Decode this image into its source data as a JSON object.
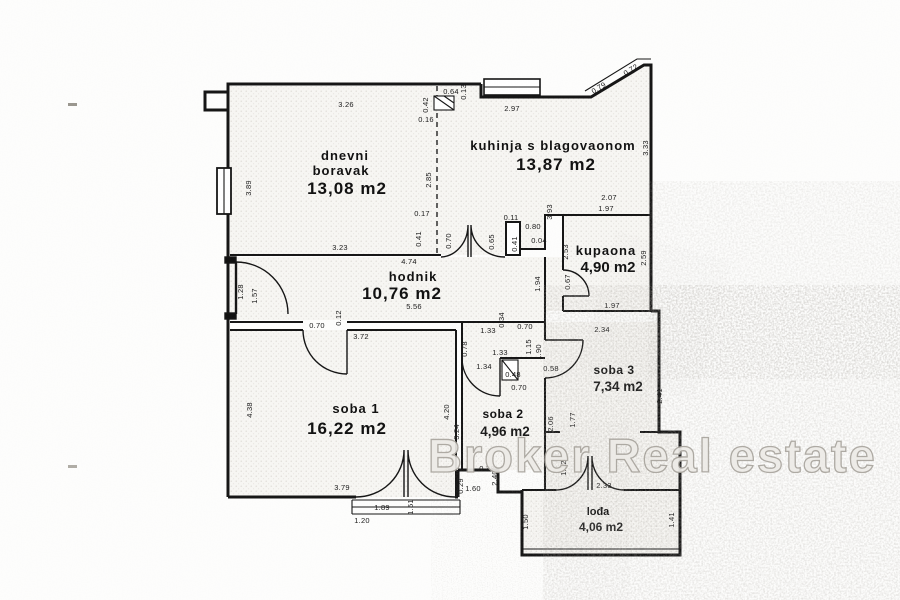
{
  "watermark": {
    "text": "Broker Real estate"
  },
  "rooms": [
    {
      "id": "dnevni-boravak",
      "line1": "dnevni",
      "line2": "boravak",
      "area": "13,08 m2"
    },
    {
      "id": "kuhinja-s-blagovaonom",
      "line1": "kuhinja s blagovaonom",
      "area": "13,87 m2"
    },
    {
      "id": "kupaona",
      "line1": "kupaona",
      "area": "4,90 m2"
    },
    {
      "id": "hodnik",
      "line1": "hodnik",
      "area": "10,76 m2"
    },
    {
      "id": "soba-1",
      "line1": "soba 1",
      "area": "16,22 m2"
    },
    {
      "id": "soba-2",
      "line1": "soba 2",
      "area": "4,96 m2"
    },
    {
      "id": "soba-3",
      "line1": "soba 3",
      "area": "7,34 m2"
    },
    {
      "id": "lodja",
      "line1": "lođa",
      "area": "4,06 m2"
    }
  ],
  "dims": [
    "3.26",
    "3.89",
    "3.23",
    "2.85",
    "0.42",
    "0.16",
    "0.64",
    "0.13",
    "2.97",
    "3.33",
    "2.07",
    "0.79",
    "0.72",
    "1.97",
    "2.53",
    "2.59",
    "1.97",
    "1.94",
    "0.67",
    "0.11",
    "0.80",
    "0.04",
    "0.41",
    "3.93",
    "4.74",
    "5.56",
    "1.28",
    "1.57",
    "0.70",
    "0.65",
    "0.12",
    "0.70",
    "0.34",
    "0.70",
    "1.33",
    "3.72",
    "4.38",
    "4.20",
    "3.79",
    "1.89",
    "1.51",
    "1.20",
    "0.78",
    "1.33",
    "1.34",
    "1.15",
    "0.48",
    "0.58",
    "1.90",
    "2.34",
    "2.06",
    "1.77",
    "3.24",
    "0.70",
    "2.41",
    "0.38",
    "2.40",
    "1.60",
    "0.29",
    "1.12",
    "1.41",
    "2.33",
    "1.50",
    "1.41",
    "0.17",
    "0.41"
  ]
}
